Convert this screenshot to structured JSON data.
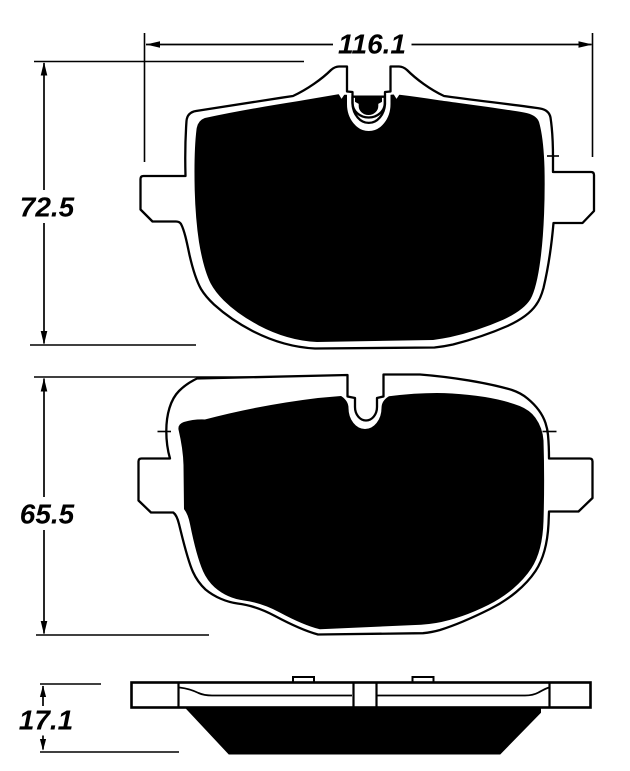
{
  "colors": {
    "background": "#ffffff",
    "ink": "#000000"
  },
  "dimensions": {
    "pad1_width": "116.1",
    "pad1_height": "72.5",
    "pad2_height": "65.5",
    "pad_thickness": "17.1"
  }
}
